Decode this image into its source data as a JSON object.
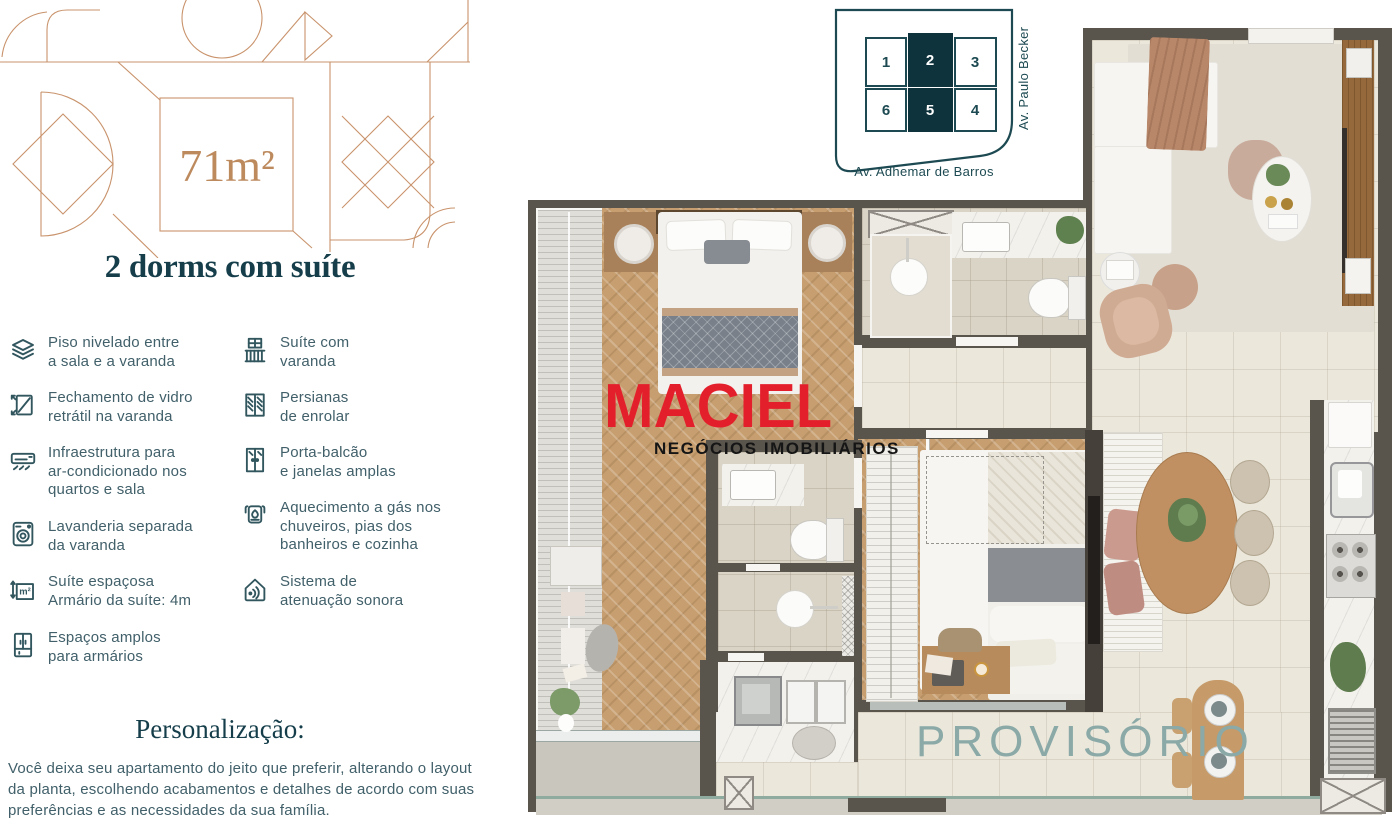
{
  "left_panel": {
    "area_label": "71m²",
    "title": "2 dorms com suíte",
    "features_col1": [
      {
        "icon": "floor-layers-icon",
        "text": "Piso nivelado entre\na sala e a varanda"
      },
      {
        "icon": "retractable-glass-icon",
        "text": "Fechamento de vidro\nretrátil na varanda"
      },
      {
        "icon": "air-conditioner-icon",
        "text": "Infraestrutura para\nar-condicionado nos\nquartos e sala"
      },
      {
        "icon": "washer-icon",
        "text": "Lavanderia separada\nda varanda"
      },
      {
        "icon": "area-m2-icon",
        "text": "Suíte espaçosa\nArmário da suíte: 4m"
      },
      {
        "icon": "wardrobe-icon",
        "text": "Espaços amplos\npara armários"
      }
    ],
    "features_col2": [
      {
        "icon": "balcony-icon",
        "text": "Suíte com\nvaranda"
      },
      {
        "icon": "roller-blind-icon",
        "text": "Persianas\nde enrolar"
      },
      {
        "icon": "balcony-door-icon",
        "text": "Porta-balcão\ne janelas amplas"
      },
      {
        "icon": "gas-heater-icon",
        "text": "Aquecimento a gás nos\nchuveiros, pias dos\nbanheiros e cozinha"
      },
      {
        "icon": "sound-insulation-icon",
        "text": "Sistema de\natenuação sonora"
      }
    ],
    "personalization_heading": "Personalização:",
    "personalization_body": "Você deixa seu apartamento do jeito que preferir, alterando o layout da planta, escolhendo acabamentos e detalhes de acordo com suas preferências e as necessidades da sua família."
  },
  "site_map": {
    "units": [
      {
        "number": "1",
        "highlighted": false
      },
      {
        "number": "2",
        "highlighted": true
      },
      {
        "number": "3",
        "highlighted": false
      },
      {
        "number": "6",
        "highlighted": false
      },
      {
        "number": "5",
        "highlighted": true
      },
      {
        "number": "4",
        "highlighted": false
      }
    ],
    "street_right": "Av. Paulo Becker",
    "street_bottom": "Av. Adhemar de Barros"
  },
  "floor_plan": {
    "brand": "MACIEL",
    "brand_subtitle": "NEGÓCIOS IMOBILIÁRIOS",
    "status_watermark": "PROVISÓRIO"
  },
  "colors": {
    "accent_tan": "#c9936c",
    "teal_dark": "#153e4a",
    "text_teal": "#41606a",
    "brand_red": "#e41f2c",
    "watermark_teal": "#8aa9a7",
    "sitemap_highlight": "#0f333c",
    "wall_gray": "#59544c"
  }
}
